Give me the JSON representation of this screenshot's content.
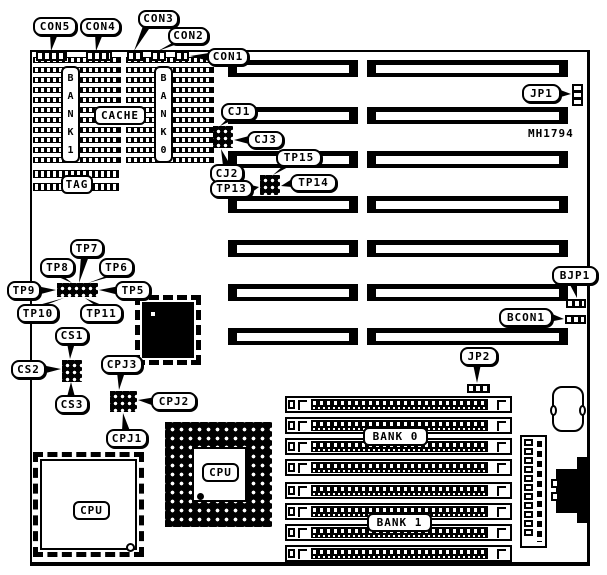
{
  "board": {
    "part_number": "MH1794"
  },
  "callouts": [
    {
      "id": "con5",
      "label": "CON5"
    },
    {
      "id": "con4",
      "label": "CON4"
    },
    {
      "id": "con3",
      "label": "CON3"
    },
    {
      "id": "con2",
      "label": "CON2"
    },
    {
      "id": "con1",
      "label": "CON1"
    },
    {
      "id": "cj1",
      "label": "CJ1"
    },
    {
      "id": "cj3",
      "label": "CJ3"
    },
    {
      "id": "cj2",
      "label": "CJ2"
    },
    {
      "id": "tp15",
      "label": "TP15"
    },
    {
      "id": "tp13",
      "label": "TP13"
    },
    {
      "id": "tp14",
      "label": "TP14"
    },
    {
      "id": "jp1",
      "label": "JP1"
    },
    {
      "id": "bjp1",
      "label": "BJP1"
    },
    {
      "id": "bcon1",
      "label": "BCON1"
    },
    {
      "id": "jp2",
      "label": "JP2"
    },
    {
      "id": "tp7",
      "label": "TP7"
    },
    {
      "id": "tp8",
      "label": "TP8"
    },
    {
      "id": "tp6",
      "label": "TP6"
    },
    {
      "id": "tp9",
      "label": "TP9"
    },
    {
      "id": "tp5",
      "label": "TP5"
    },
    {
      "id": "tp10",
      "label": "TP10"
    },
    {
      "id": "tp11",
      "label": "TP11"
    },
    {
      "id": "cs1",
      "label": "CS1"
    },
    {
      "id": "cs2",
      "label": "CS2"
    },
    {
      "id": "cs3",
      "label": "CS3"
    },
    {
      "id": "cpj3",
      "label": "CPJ3"
    },
    {
      "id": "cpj2",
      "label": "CPJ2"
    },
    {
      "id": "cpj1",
      "label": "CPJ1"
    }
  ],
  "memory": {
    "bank1": "BANK 1",
    "bank0": "BANK 0",
    "cache": "CACHE",
    "tag": "TAG"
  },
  "simm": {
    "bank0": "BANK 0",
    "bank1": "BANK 1"
  },
  "cpus": {
    "qfp": "CPU",
    "pga": "CPU"
  }
}
